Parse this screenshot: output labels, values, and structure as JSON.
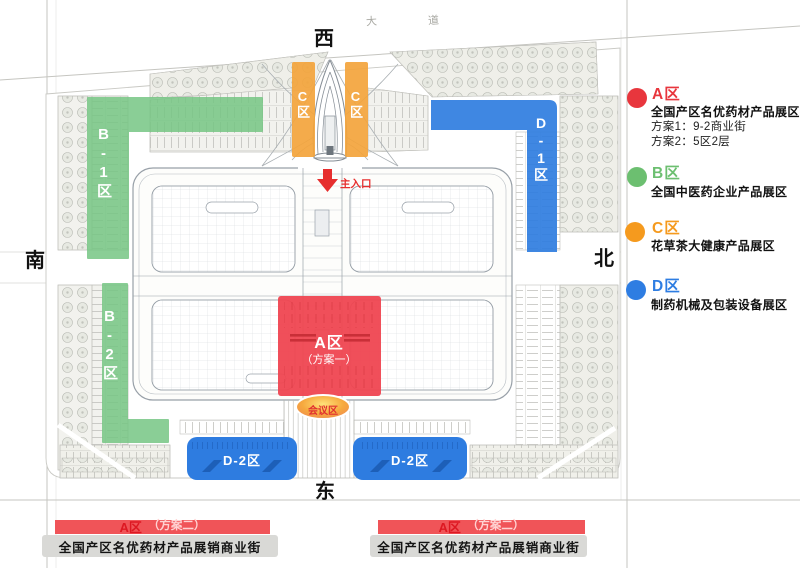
{
  "compass": {
    "west": "西",
    "south": "南",
    "north": "北",
    "east": "东"
  },
  "road_labels": {
    "char1": "大",
    "char2": "道"
  },
  "map": {
    "entrance_label": "主入口",
    "conference_label": "会议区",
    "zone_a": {
      "label": "A区",
      "sub": "（方案一）"
    },
    "zone_b1_label": "B-1区",
    "zone_b2_label": "B-2区",
    "zone_c_left_label": "C区",
    "zone_c_right_label": "C区",
    "zone_d1_label": "D-1区",
    "zone_d2_left_label": "D-2区",
    "zone_d2_right_label": "D-2区"
  },
  "colors": {
    "zone_a_red": "#ef4651",
    "zone_b_green": "#76c684",
    "zone_c_orange": "#f3a43c",
    "zone_d_blue": "#2e7ce0",
    "entrance_red": "#e62e2e",
    "conference_gradient": [
      "#ffe27a",
      "#f6a93e",
      "#ef8752"
    ]
  },
  "legend": {
    "items": [
      {
        "title": "A区",
        "color": "#e8363d",
        "desc": "全国产区名优药材产品展区",
        "line1": "方案1：9-2商业街",
        "line2": "方案2：5区2层"
      },
      {
        "title": "B区",
        "color": "#6cbf70",
        "desc": "全国中医药企业产品展区",
        "line1": "",
        "line2": ""
      },
      {
        "title": "C区",
        "color": "#f59a1e",
        "desc": "花草茶大健康产品展区",
        "line1": "",
        "line2": ""
      },
      {
        "title": "D区",
        "color": "#2e7de2",
        "desc": "制药机械及包装设备展区",
        "line1": "",
        "line2": ""
      }
    ]
  },
  "banners": {
    "left": {
      "zone": "A区",
      "plan": "（方案二）",
      "desc": "全国产区名优药材产品展销商业街"
    },
    "right": {
      "zone": "A区",
      "plan": "（方案二）",
      "desc": "全国产区名优药材产品展销商业街"
    }
  }
}
